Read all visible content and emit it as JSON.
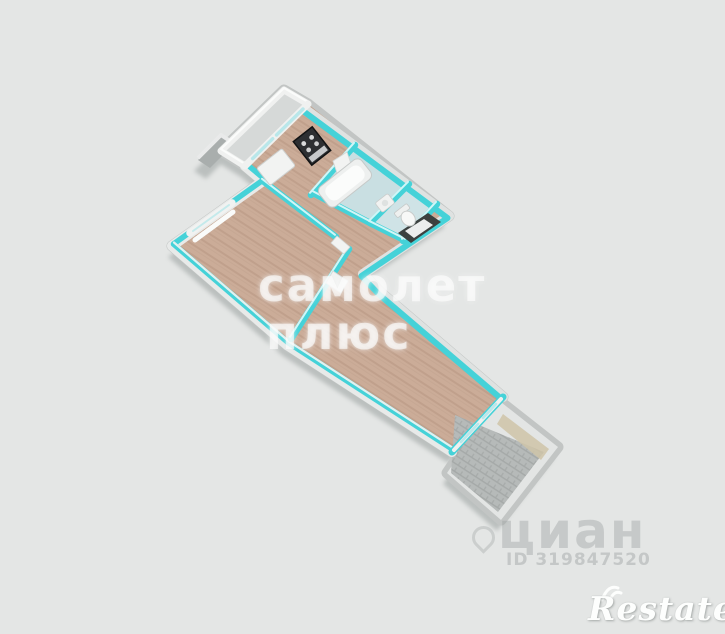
{
  "scene": {
    "type": "3d-floorplan-render",
    "rooms": [
      "balcony-top",
      "kitchen",
      "bathroom",
      "toilet",
      "hallway",
      "living-room",
      "long-room",
      "balcony-bottom"
    ],
    "furniture": [
      "stove",
      "kitchen-table",
      "bathtub",
      "bathroom-sink",
      "toilet-bowl",
      "entry-door",
      "interior-doors",
      "windows"
    ]
  },
  "watermarks": {
    "brand_line1": "самолет",
    "brand_line2": "плюс",
    "portal": "циан",
    "listing_id": "ID 319847520",
    "agency": "Restate"
  },
  "colors": {
    "background": "#e4e6e5",
    "wall_cyan": "#45d2d8",
    "wall_top": "#d9f8f9",
    "wall_white": "#f0f1f0",
    "exterior_gray": "#c2c5c4",
    "shadow_gray": "#9aa09f",
    "floor_wood": "#cbac98",
    "floor_wood_stripe": "#bd9e8a",
    "bathroom_floor": "#c9dfe2",
    "balcony_floor": "#b6bab9",
    "balcony_floor_line": "#a5a9a8",
    "glass": "#b9e7ea",
    "door_dark": "#3c4140",
    "watermark_white": "rgba(255,255,255,0.62)",
    "watermark_gray": "rgba(150,156,155,0.38)"
  }
}
